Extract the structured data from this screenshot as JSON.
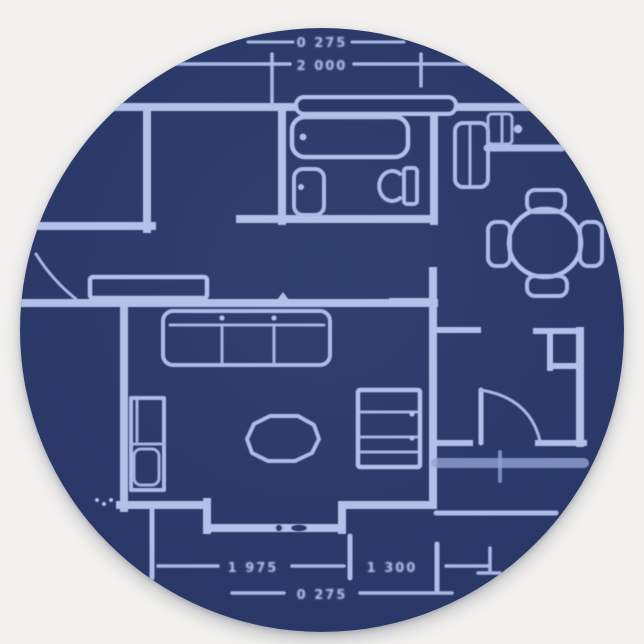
{
  "colors": {
    "background": "#f2f1ef",
    "sticker_navy": "#2c3a6a",
    "blueprint_line": "#b3c0ea",
    "blueprint_line_soft": "#94a3d4"
  },
  "dims": {
    "top_secondary": "0 275",
    "top_primary": "2 000",
    "bottom_left": "1 975",
    "bottom_right": "1 300",
    "bottom_secondary": "0 275"
  }
}
